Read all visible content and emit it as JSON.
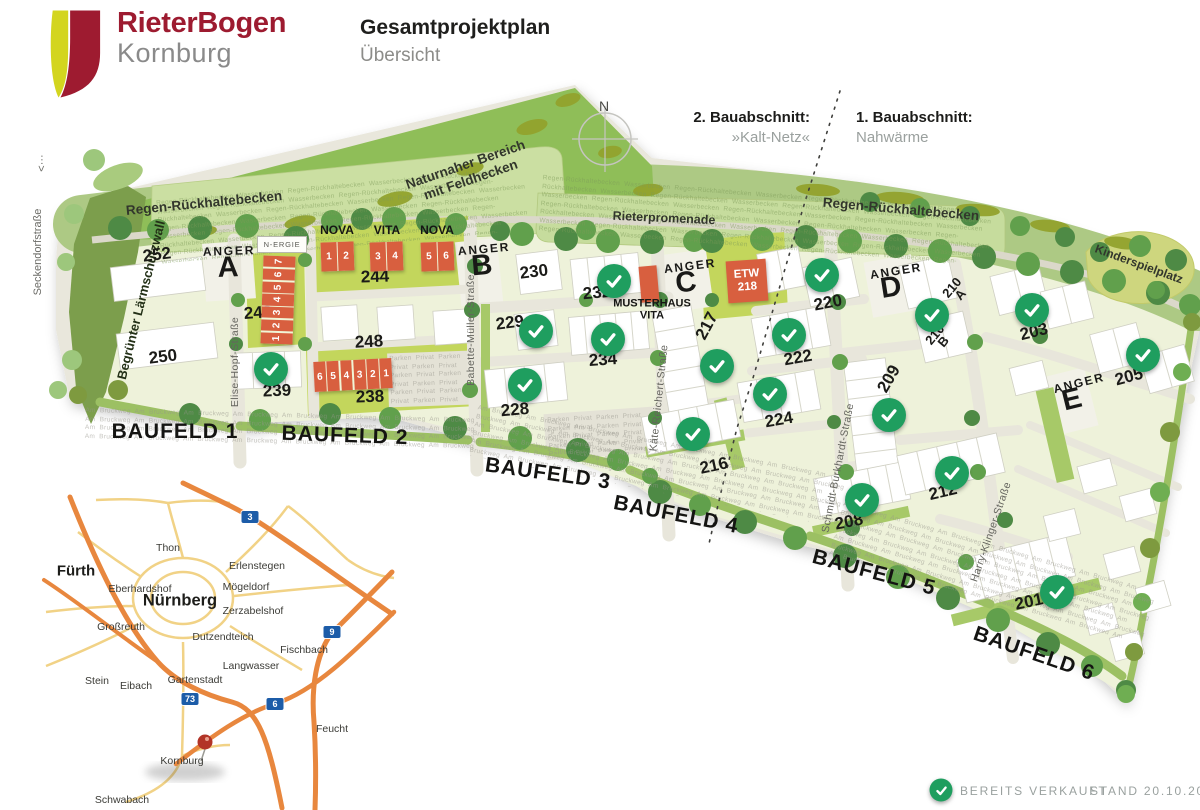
{
  "header": {
    "logo_title": "RieterBogen",
    "logo_subtitle": "Kornburg",
    "title": "Gesamtprojektplan",
    "subtitle": "Übersicht"
  },
  "phases": {
    "phase2_label": "2. Bauabschnitt:",
    "phase2_value": "»Kalt-Netz«",
    "phase1_label": "1. Bauabschnitt:",
    "phase1_value": "Nahwärme"
  },
  "compass": {
    "north": "N"
  },
  "areas": {
    "seckendorf_arrow": "<···",
    "seckendorf": "Seckendorfstraße",
    "wall": "Begrünter Lärmschutzwall",
    "regen": "Regen-Rückhaltebecken",
    "naturnah_line1": "Naturnaher Bereich",
    "naturnah_line2": "mit Feldhecken",
    "promenade": "Rieterpromenade",
    "playground": "Kinderspielplatz",
    "n_ergie": "N-ERGIE"
  },
  "streets": {
    "elise": "Elise-Hopf-Straße",
    "babette": "Babette-Müller-Straße",
    "kaete": "Käte-Reichert-Straße",
    "schmidt": "Schmidt-Burkhardt-Straße",
    "harry": "Harry-Klinger-Straße"
  },
  "anger_word": "ANGER",
  "anger_letters": [
    "A",
    "B",
    "C",
    "D",
    "E"
  ],
  "baufeld_labels": [
    "BAUFELD 1",
    "BAUFELD 2",
    "BAUFELD 3",
    "BAUFELD 4",
    "BAUFELD 5",
    "BAUFELD 6"
  ],
  "lots": [
    {
      "id": "252",
      "sold": false
    },
    {
      "id": "250",
      "sold": false
    },
    {
      "id": "240",
      "sold": false
    },
    {
      "id": "239",
      "sold": true
    },
    {
      "id": "244",
      "sold": false
    },
    {
      "id": "248",
      "sold": false
    },
    {
      "id": "238",
      "sold": false
    },
    {
      "id": "230",
      "sold": false
    },
    {
      "id": "232",
      "sold": true
    },
    {
      "id": "229",
      "sold": true
    },
    {
      "id": "234",
      "sold": true
    },
    {
      "id": "228",
      "sold": true
    },
    {
      "id": "217",
      "sold": true
    },
    {
      "id": "216",
      "sold": true
    },
    {
      "id": "220",
      "sold": true
    },
    {
      "id": "222",
      "sold": true
    },
    {
      "id": "224",
      "sold": true
    },
    {
      "id": "209",
      "sold": true
    },
    {
      "id": "212",
      "sold": true
    },
    {
      "id": "208",
      "sold": true
    },
    {
      "id": "210",
      "sub": "A",
      "sold": true
    },
    {
      "id": "210",
      "sub": "B",
      "sold": false
    },
    {
      "id": "203",
      "sold": true
    },
    {
      "id": "205",
      "sold": true
    },
    {
      "id": "201",
      "sold": true
    }
  ],
  "buildings": {
    "nova_left_label": "NOVA",
    "vita_label": "VITA",
    "nova_right_label": "NOVA",
    "nova_left_units": [
      "1",
      "2"
    ],
    "vita_units": [
      "3",
      "4"
    ],
    "nova_right_units": [
      "5",
      "6"
    ],
    "row240_units": [
      "7",
      "6",
      "5",
      "4",
      "3",
      "2",
      "1"
    ],
    "row238_units": [
      "6",
      "5",
      "4",
      "3",
      "2",
      "1"
    ],
    "etw_line1": "ETW",
    "etw_line2": "218",
    "musterhaus_line1": "MUSTERHAUS",
    "musterhaus_line2": "VITA"
  },
  "legend": {
    "sold": "BEREITS VERKAUFT",
    "stand": "STAND 20.10.2025"
  },
  "textures": {
    "basin": "Regen-Rückhaltebecken Wasserbecken ",
    "bruckweg": "Am Bruckweg ",
    "parken": "Parken Privat "
  },
  "inset": {
    "cities": [
      {
        "name": "Fürth",
        "bold": true
      },
      {
        "name": "Thon"
      },
      {
        "name": "Erlenstegen"
      },
      {
        "name": "Eberhardshof"
      },
      {
        "name": "Mögeldorf"
      },
      {
        "name": "Nürnberg",
        "bold": true
      },
      {
        "name": "Zerzabelshof"
      },
      {
        "name": "Großreuth"
      },
      {
        "name": "Dutzendteich"
      },
      {
        "name": "Fischbach"
      },
      {
        "name": "Langwasser"
      },
      {
        "name": "Stein"
      },
      {
        "name": "Eibach"
      },
      {
        "name": "Gartenstadt"
      },
      {
        "name": "Feucht"
      },
      {
        "name": "Kornburg"
      },
      {
        "name": "Schwabach"
      }
    ],
    "badges": [
      "3",
      "9",
      "73",
      "6"
    ]
  },
  "colors": {
    "brand_red": "#9e1b30",
    "brand_yellow": "#d3d51f",
    "sold_green": "#1f9e5f",
    "building_red": "#d85f3f",
    "lot_green": "#c3d65c",
    "badge_blue": "#1c5ca8"
  }
}
